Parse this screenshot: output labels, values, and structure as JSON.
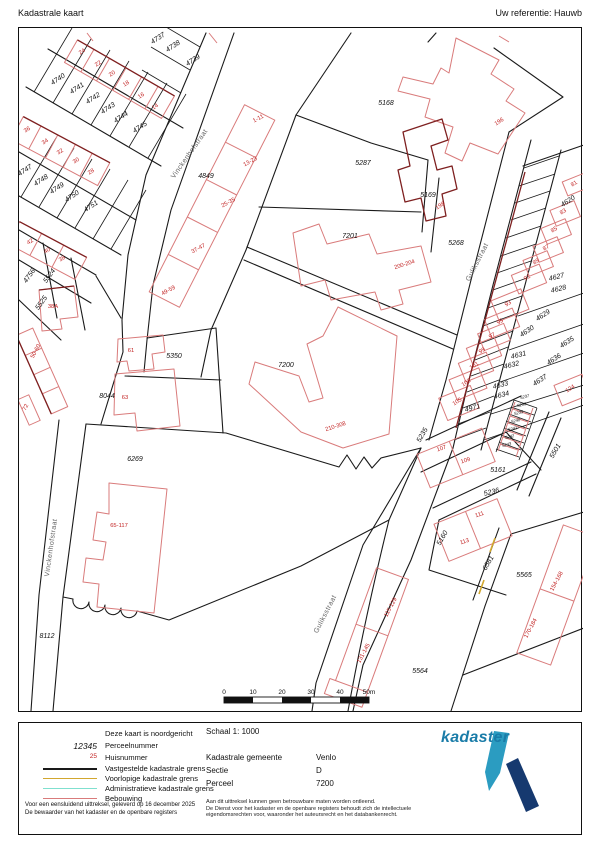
{
  "header": {
    "title": "Kadastrale kaart",
    "reference": "Uw referentie: Hauwb"
  },
  "legend": {
    "north_note": "Deze kaart is noordgericht",
    "perceel": {
      "symbol": "12345",
      "label": "Perceelnummer"
    },
    "huis": {
      "symbol": "25",
      "label": "Huisnummer"
    },
    "lines": [
      {
        "label": "Vastgestelde kadastrale grens",
        "color": "#1a1a1a"
      },
      {
        "label": "Voorlopige kadastrale grens",
        "color": "#d2a72e"
      },
      {
        "label": "Administratieve kadastrale grens",
        "color": "#7fe0cf"
      },
      {
        "label": "Bebouwing",
        "color": "#d97b7b"
      }
    ],
    "footer": [
      "Voor een eensluidend uittreksel, geleverd op 16 december 2025",
      "De bewaarder van het kadaster en de openbare registers"
    ]
  },
  "info": {
    "scale_label": "Schaal 1: 1000",
    "rows": [
      {
        "label": "Kadastrale gemeente",
        "value": "Venlo"
      },
      {
        "label": "Sectie",
        "value": "D"
      },
      {
        "label": "Perceel",
        "value": "7200"
      }
    ],
    "disclaimer": [
      "Aan dit uittreksel kunnen geen betrouwbare maten worden ontleend.",
      "De Dienst voor het kadaster en de openbare registers behoudt zich de intellectuele",
      "eigendomsrechten voor, waaronder het auteursrecht en het databankenrecht."
    ]
  },
  "logo": {
    "text": "kadaster",
    "text_color": "#1a7ca8",
    "pen_color": "#2b9cc1",
    "bar_color": "#16396f"
  },
  "map": {
    "scalebar": {
      "labels": [
        "0",
        "10",
        "20",
        "30",
        "40",
        "50m"
      ]
    },
    "street_labels": [
      {
        "t": "Vinckenhofstraat",
        "x": 190,
        "y": 155,
        "r": -55
      },
      {
        "t": "Vinckenhofstraat",
        "x": 52,
        "y": 548,
        "r": -82
      },
      {
        "t": "Guliksstraat",
        "x": 478,
        "y": 263,
        "r": -63
      },
      {
        "t": "Guliksstraat",
        "x": 326,
        "y": 615,
        "r": -63
      }
    ],
    "parcel_labels": [
      {
        "t": "4737",
        "x": 158,
        "y": 40,
        "r": -33
      },
      {
        "t": "4738",
        "x": 173,
        "y": 48,
        "r": -33
      },
      {
        "t": "4739",
        "x": 193,
        "y": 62,
        "r": -33
      },
      {
        "t": "4740",
        "x": 58,
        "y": 81,
        "r": -33
      },
      {
        "t": "4741",
        "x": 77,
        "y": 90,
        "r": -33
      },
      {
        "t": "4742",
        "x": 93,
        "y": 100,
        "r": -33
      },
      {
        "t": "4743",
        "x": 108,
        "y": 110,
        "r": -33
      },
      {
        "t": "4744",
        "x": 121,
        "y": 119,
        "r": -33
      },
      {
        "t": "4745",
        "x": 140,
        "y": 129,
        "r": -33
      },
      {
        "t": "4747",
        "x": 25,
        "y": 172,
        "r": -33
      },
      {
        "t": "4748",
        "x": 41,
        "y": 182,
        "r": -33
      },
      {
        "t": "4749",
        "x": 57,
        "y": 190,
        "r": -33
      },
      {
        "t": "4750",
        "x": 72,
        "y": 198,
        "r": -33
      },
      {
        "t": "4751",
        "x": 91,
        "y": 208,
        "r": -33
      },
      {
        "t": "4756",
        "x": 30,
        "y": 277,
        "r": -55
      },
      {
        "t": "5524",
        "x": 50,
        "y": 277,
        "r": -55
      },
      {
        "t": "5525",
        "x": 42,
        "y": 304,
        "r": -55
      },
      {
        "t": "4849",
        "x": 205,
        "y": 178,
        "r": 0
      },
      {
        "t": "5168",
        "x": 385,
        "y": 105,
        "r": 0
      },
      {
        "t": "5287",
        "x": 362,
        "y": 165,
        "r": 0
      },
      {
        "t": "5169",
        "x": 427,
        "y": 197,
        "r": 0
      },
      {
        "t": "7201",
        "x": 349,
        "y": 238,
        "r": 0
      },
      {
        "t": "5268",
        "x": 455,
        "y": 245,
        "r": 0
      },
      {
        "t": "7200",
        "x": 285,
        "y": 367,
        "r": 0
      },
      {
        "t": "5350",
        "x": 173,
        "y": 358,
        "r": 0
      },
      {
        "t": "8044",
        "x": 106,
        "y": 398,
        "r": 0
      },
      {
        "t": "6269",
        "x": 134,
        "y": 461,
        "r": 0
      },
      {
        "t": "8112",
        "x": 46,
        "y": 638,
        "r": 0
      },
      {
        "t": "4620",
        "x": 568,
        "y": 203,
        "r": -33
      },
      {
        "t": "4627",
        "x": 556,
        "y": 279,
        "r": -14
      },
      {
        "t": "4628",
        "x": 558,
        "y": 291,
        "r": -14
      },
      {
        "t": "4629",
        "x": 543,
        "y": 317,
        "r": -33
      },
      {
        "t": "4630",
        "x": 527,
        "y": 333,
        "r": -33
      },
      {
        "t": "4631",
        "x": 518,
        "y": 357,
        "r": -14
      },
      {
        "t": "4632",
        "x": 511,
        "y": 367,
        "r": -14
      },
      {
        "t": "4633",
        "x": 500,
        "y": 387,
        "r": -14
      },
      {
        "t": "4634",
        "x": 501,
        "y": 397,
        "r": -14
      },
      {
        "t": "4635",
        "x": 567,
        "y": 344,
        "r": -33
      },
      {
        "t": "4636",
        "x": 554,
        "y": 361,
        "r": -33
      },
      {
        "t": "4637",
        "x": 540,
        "y": 382,
        "r": -33
      },
      {
        "t": "4971",
        "x": 472,
        "y": 410,
        "r": -14
      },
      {
        "t": "5235",
        "x": 423,
        "y": 436,
        "r": -60
      },
      {
        "t": "5161",
        "x": 497,
        "y": 472,
        "r": 0
      },
      {
        "t": "5236",
        "x": 491,
        "y": 494,
        "r": -14
      },
      {
        "t": "5160",
        "x": 443,
        "y": 539,
        "r": -60
      },
      {
        "t": "6581",
        "x": 489,
        "y": 564,
        "r": -60
      },
      {
        "t": "5501",
        "x": 556,
        "y": 452,
        "r": -60
      },
      {
        "t": "5237",
        "x": 524,
        "y": 398,
        "r": -14,
        "s": 4
      },
      {
        "t": "5238",
        "x": 521,
        "y": 406,
        "r": -14,
        "s": 4
      },
      {
        "t": "5239",
        "x": 518,
        "y": 414,
        "r": -14,
        "s": 4
      },
      {
        "t": "5240",
        "x": 515,
        "y": 422,
        "r": -14,
        "s": 4
      },
      {
        "t": "5241",
        "x": 512,
        "y": 430,
        "r": -14,
        "s": 4
      },
      {
        "t": "5242",
        "x": 509,
        "y": 438,
        "r": -14,
        "s": 4
      },
      {
        "t": "5243",
        "x": 506,
        "y": 446,
        "r": -14,
        "s": 4
      },
      {
        "t": "5564",
        "x": 419,
        "y": 673,
        "r": 0
      },
      {
        "t": "5565",
        "x": 523,
        "y": 577,
        "r": 0
      }
    ],
    "house_numbers": [
      {
        "t": "24",
        "x": 82,
        "y": 53,
        "r": -33
      },
      {
        "t": "22",
        "x": 98,
        "y": 65,
        "r": -33
      },
      {
        "t": "20",
        "x": 112,
        "y": 75,
        "r": -33
      },
      {
        "t": "18",
        "x": 126,
        "y": 85,
        "r": -33
      },
      {
        "t": "16",
        "x": 141,
        "y": 97,
        "r": -33
      },
      {
        "t": "14",
        "x": 155,
        "y": 108,
        "r": -33
      },
      {
        "t": "36",
        "x": 27,
        "y": 131,
        "r": -33
      },
      {
        "t": "34",
        "x": 45,
        "y": 143,
        "r": -33
      },
      {
        "t": "32",
        "x": 60,
        "y": 153,
        "r": -33
      },
      {
        "t": "30",
        "x": 76,
        "y": 162,
        "r": -33
      },
      {
        "t": "28",
        "x": 91,
        "y": 173,
        "r": -33
      },
      {
        "t": "42",
        "x": 30,
        "y": 243,
        "r": -33
      },
      {
        "t": "40",
        "x": 47,
        "y": 252,
        "r": -33
      },
      {
        "t": "38",
        "x": 62,
        "y": 260,
        "r": -33
      },
      {
        "t": "38A",
        "x": 52,
        "y": 308,
        "r": 0
      },
      {
        "t": "50-60",
        "x": 36,
        "y": 352,
        "r": -62
      },
      {
        "t": "72",
        "x": 26,
        "y": 408,
        "r": -62
      },
      {
        "t": "61",
        "x": 130,
        "y": 352,
        "r": 0
      },
      {
        "t": "63",
        "x": 124,
        "y": 399,
        "r": 0
      },
      {
        "t": "65-117",
        "x": 118,
        "y": 527,
        "r": 0
      },
      {
        "t": "1-11",
        "x": 258,
        "y": 120,
        "r": -28
      },
      {
        "t": "13-23",
        "x": 250,
        "y": 163,
        "r": -28
      },
      {
        "t": "25-35",
        "x": 228,
        "y": 204,
        "r": -28
      },
      {
        "t": "37-47",
        "x": 198,
        "y": 250,
        "r": -28
      },
      {
        "t": "49-59",
        "x": 168,
        "y": 292,
        "r": -28
      },
      {
        "t": "196",
        "x": 499,
        "y": 123,
        "r": -33
      },
      {
        "t": "198",
        "x": 440,
        "y": 207,
        "r": -33
      },
      {
        "t": "200-204",
        "x": 404,
        "y": 266,
        "r": -18
      },
      {
        "t": "210-308",
        "x": 335,
        "y": 428,
        "r": -18
      },
      {
        "t": "81",
        "x": 574,
        "y": 185,
        "r": -33
      },
      {
        "t": "83",
        "x": 563,
        "y": 213,
        "r": -33
      },
      {
        "t": "85",
        "x": 554,
        "y": 231,
        "r": -33
      },
      {
        "t": "87",
        "x": 546,
        "y": 249,
        "r": -33
      },
      {
        "t": "89",
        "x": 536,
        "y": 263,
        "r": -33
      },
      {
        "t": "91",
        "x": 527,
        "y": 279,
        "r": -33
      },
      {
        "t": "93",
        "x": 508,
        "y": 305,
        "r": -33
      },
      {
        "t": "95",
        "x": 500,
        "y": 323,
        "r": -33
      },
      {
        "t": "97",
        "x": 492,
        "y": 337,
        "r": -33
      },
      {
        "t": "99",
        "x": 482,
        "y": 352,
        "r": -33
      },
      {
        "t": "101",
        "x": 474,
        "y": 367,
        "r": -33
      },
      {
        "t": "103",
        "x": 466,
        "y": 384,
        "r": -33
      },
      {
        "t": "105",
        "x": 457,
        "y": 403,
        "r": -33
      },
      {
        "t": "124",
        "x": 570,
        "y": 390,
        "r": -33
      },
      {
        "t": "107",
        "x": 441,
        "y": 450,
        "r": -18
      },
      {
        "t": "109",
        "x": 465,
        "y": 462,
        "r": -18
      },
      {
        "t": "111",
        "x": 479,
        "y": 516,
        "r": -18
      },
      {
        "t": "113",
        "x": 464,
        "y": 543,
        "r": -18
      },
      {
        "t": "115-129",
        "x": 391,
        "y": 608,
        "r": -62
      },
      {
        "t": "131-145",
        "x": 364,
        "y": 654,
        "r": -62
      },
      {
        "t": "154-168",
        "x": 557,
        "y": 582,
        "r": -62
      },
      {
        "t": "170-184",
        "x": 531,
        "y": 629,
        "r": -62
      }
    ]
  }
}
